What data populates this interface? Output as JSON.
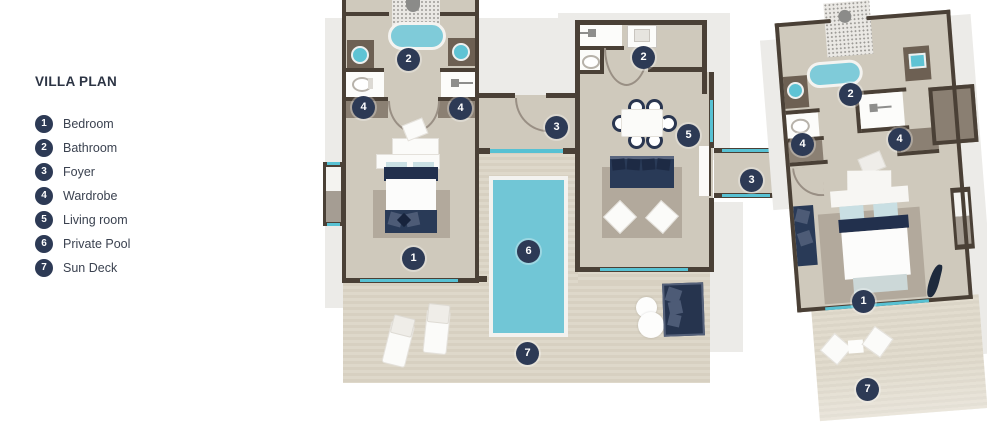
{
  "title": "VILLA PLAN",
  "legend": {
    "items": [
      {
        "num": "1",
        "label": "Bedroom"
      },
      {
        "num": "2",
        "label": "Bathroom"
      },
      {
        "num": "3",
        "label": "Foyer"
      },
      {
        "num": "4",
        "label": "Wardrobe"
      },
      {
        "num": "5",
        "label": "Living room"
      },
      {
        "num": "6",
        "label": "Private Pool"
      },
      {
        "num": "7",
        "label": "Sun Deck"
      }
    ]
  },
  "plan": {
    "badges": [
      {
        "num": "2"
      },
      {
        "num": "4"
      },
      {
        "num": "4"
      },
      {
        "num": "2"
      },
      {
        "num": "3"
      },
      {
        "num": "5"
      },
      {
        "num": "3"
      },
      {
        "num": "1"
      },
      {
        "num": "6"
      },
      {
        "num": "7"
      },
      {
        "num": "2"
      },
      {
        "num": "4"
      },
      {
        "num": "4"
      },
      {
        "num": "1"
      },
      {
        "num": "7"
      }
    ]
  },
  "colors": {
    "badge_navy": "#2d3a55",
    "wall_brown": "#4a4036",
    "window_cyan": "#57c1d3",
    "pool_cyan": "#71c6d6",
    "floor_taupe": "#cfc9bc",
    "deck_tan": "#d7d0c1",
    "backdrop_gray": "#ecebe8",
    "furniture_navy": "#293a57",
    "text_dark": "#2c3444"
  }
}
